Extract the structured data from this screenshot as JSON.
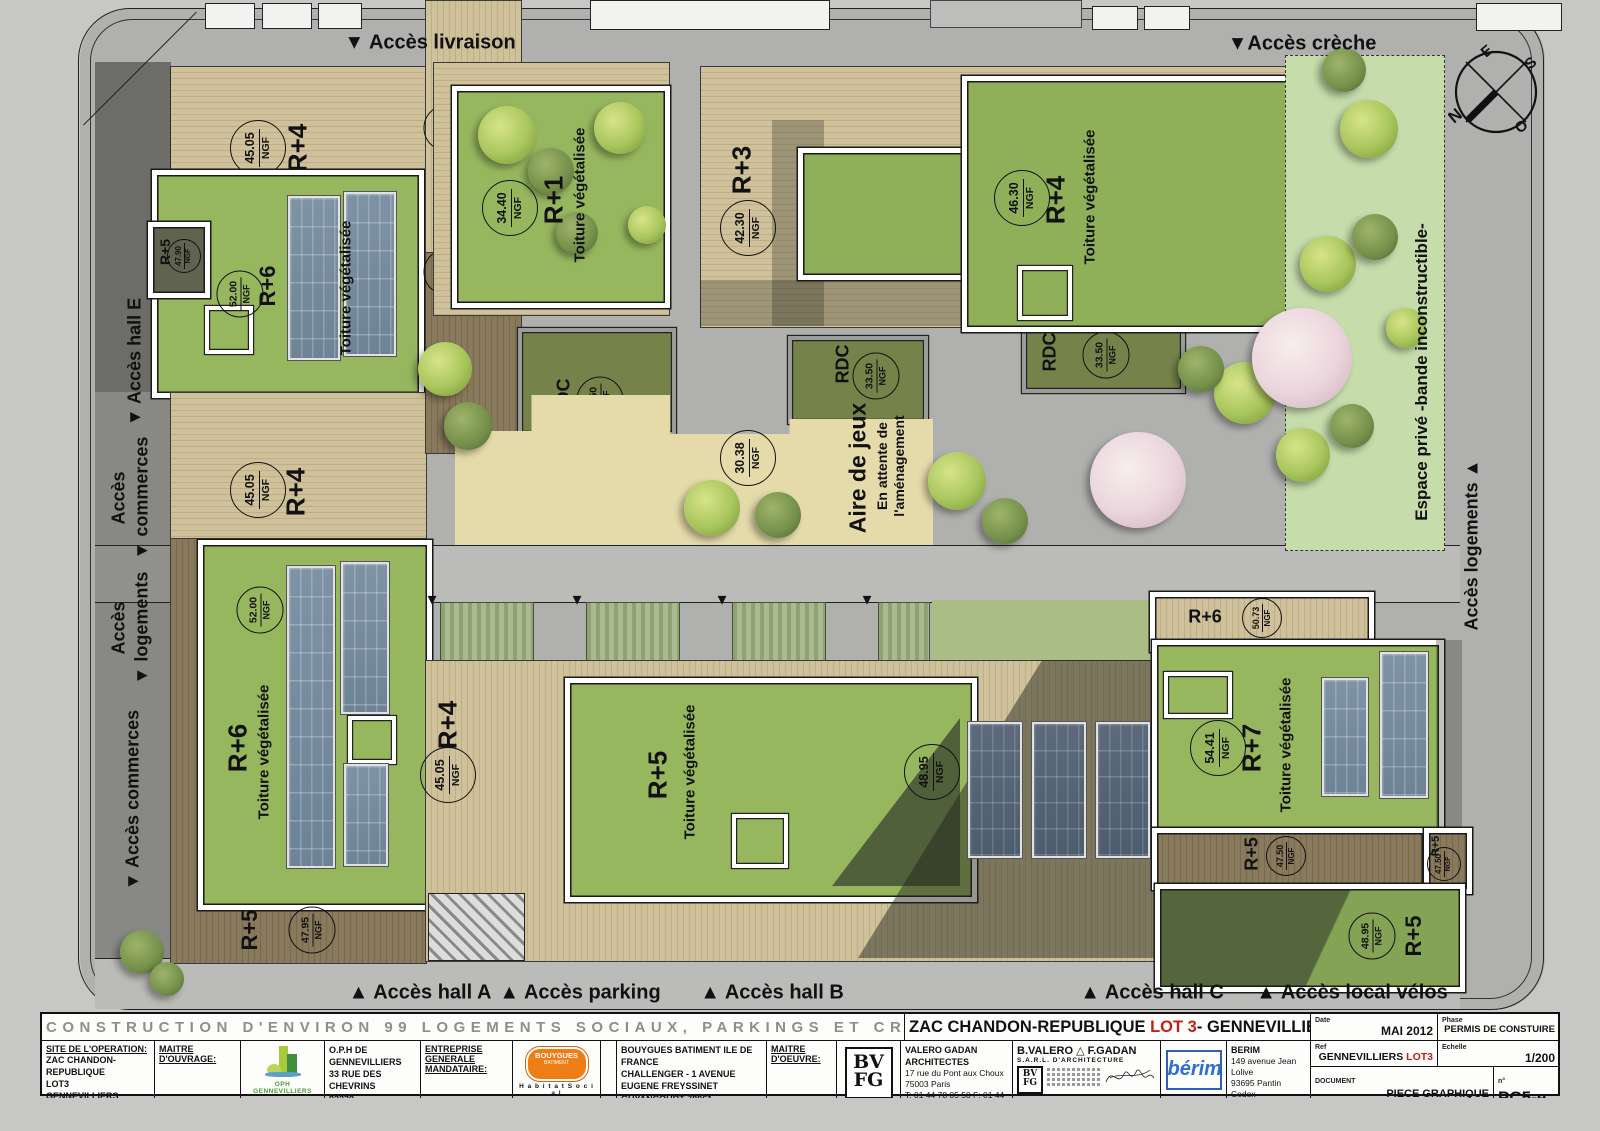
{
  "glyphs": {
    "down": "▼",
    "up": "▲"
  },
  "plan": {
    "ngf_unit": "NGF",
    "access": {
      "livraison": "Accès livraison",
      "creche": "Accès crèche",
      "hall_e": "Accès hall E",
      "commerces1_l1": "Accès",
      "commerces1_l2": "commerces",
      "logements_l1": "Accès",
      "logements_l2": "logements",
      "commerces2": "Accès commerces",
      "hall_a": "Accès hall A",
      "parking": "Accès parking",
      "hall_b": "Accès hall B",
      "hall_c": "Accès hall C",
      "velos": "Accès local vélos",
      "espace_prive": "Espace privé  -bande inconstructible-",
      "logements_r": "Accès logements"
    },
    "compass": {
      "n": "N",
      "s": "S",
      "e": "E",
      "o": "O"
    },
    "playground": {
      "name": "Aire de jeux",
      "sub1": "En attente de",
      "sub2": "l'aménagement",
      "ngf": "30.38"
    },
    "b": {
      "tl_r4": {
        "level": "R+4",
        "ngf": "45.05"
      },
      "tl_r6": {
        "level": "R+6",
        "ngf": "52.00",
        "note": "Toiture végétalisée"
      },
      "tl_r5": {
        "level": "R+5",
        "ngf": "47.90"
      },
      "r1": {
        "level": "R+1",
        "ngf": "34.40",
        "note": "Toiture végétalisée"
      },
      "deck_4215": {
        "ngf": "42.15"
      },
      "deck_3390": {
        "ngf": "33.90"
      },
      "tr_r3": {
        "level": "R+3",
        "ngf": "42.30"
      },
      "tr_r4": {
        "level": "R+4",
        "ngf": "46.30",
        "note": "Toiture végétalisée"
      },
      "tr_r3s": {
        "level": "R+3",
        "ngf": "42.30"
      },
      "rdc_l": {
        "level": "RDC",
        "ngf": "33.50"
      },
      "rdc_m": {
        "level": "RDC",
        "ngf": "33.50"
      },
      "rdc_r": {
        "level": "RDC",
        "ngf": "33.50"
      },
      "ml_r4": {
        "level": "R+4",
        "ngf": "45.05"
      },
      "bl_r6": {
        "level": "R+6",
        "ngf": "52.00",
        "note": "Toiture végétalisée"
      },
      "bl_r5": {
        "level": "R+5",
        "ngf": "47.95"
      },
      "bm_r4": {
        "level": "R+4",
        "ngf": "45.05"
      },
      "bm_r5": {
        "level": "R+5",
        "note": "Toiture végétalisée"
      },
      "bm_ngf": {
        "ngf": "48.95"
      },
      "br_r6": {
        "level": "R+6",
        "ngf": "50.73"
      },
      "br_r7": {
        "level": "R+7",
        "ngf": "54.41",
        "note": "Toiture végétalisée"
      },
      "br_r5a": {
        "level": "R+5",
        "ngf": "47.50"
      },
      "br_r5b": {
        "level": "R+5",
        "ngf": "47.50"
      },
      "br_r5c": {
        "level": "R+5",
        "ngf": "48.95"
      }
    }
  },
  "titleblock": {
    "project_title": "CONSTRUCTION D'ENVIRON 99 LOGEMENTS SOCIAUX, PARKINGS ET CRECHE",
    "loc_prefix": "ZAC CHANDON-REPUBLIQUE ",
    "loc_lot": "LOT 3",
    "loc_suffix": "- GENNEVILLIERS",
    "site": {
      "heading": "SITE DE L'OPERATION:",
      "l1": "ZAC CHANDON-REPUBLIQUE",
      "l2": "LOT3",
      "l3": "GENNEVILLIERS"
    },
    "moa": {
      "heading": "MAITRE D'OUVRAGE:",
      "logo": "OPH GENNEVILLIERS",
      "l1": "O.P.H DE GENNEVILLIERS",
      "l2": "33 RUE DES CHEVRINS",
      "l3": "92230 GENNEVILLIERS"
    },
    "ent": {
      "heading1": "ENTREPRISE GENERALE",
      "heading2": "MANDATAIRE:",
      "logo1": "BOUYGUES",
      "logo2": "BATIMENT",
      "logo_sub": "H a b i t a t   S o c i a l",
      "side": "ILE DE FRANCE",
      "l1": "BOUYGUES BATIMENT ILE DE FRANCE",
      "l2": "CHALLENGER - 1 AVENUE EUGENE FREYSSINET",
      "l3": "GUYANCOURT 78061",
      "l4": "SAINT-QUENTIN-EN-YVELINES CEDEX"
    },
    "moe": {
      "heading": "MAITRE D'OEUVRE:",
      "logo1": "BV",
      "logo2": "FG",
      "l1": "VALERO GADAN ARCHITECTES",
      "l2": "17 rue du Pont aux Choux",
      "l3": "75003 Paris",
      "l4": "T: 01 44 78 05 50  F: 01 44 78 00 93"
    },
    "arch": {
      "name1": "B.VALERO",
      "name2": "F.GADAN",
      "subtitle": "S.A.R.L.  D'ARCHITECTURE",
      "logo1": "BV",
      "logo2": "FG"
    },
    "berim": {
      "logo": "bérim",
      "l1": "BERIM",
      "l2": "149 avenue Jean Lolive",
      "l3": "93695 Pantin Cedex",
      "l4": "T: 01 41 83 94 32 F: 01 41 71 06 33"
    },
    "meta": {
      "date_label": "Date",
      "date": "MAI 2012",
      "phase_label": "Phase",
      "phase": "PERMIS DE CONSTUIRE",
      "ref_label": "Ref",
      "ref_prefix": "GENNEVILLIERS ",
      "ref_lot": "LOT3",
      "scale_label": "Echelle",
      "scale": "1/200",
      "doc_label": "DOCUMENT",
      "doc1": "PIECE GRAPHIQUE",
      "doc2": "PLAN DES TOITURES",
      "num_label": "n°",
      "num": "PC5-e"
    }
  }
}
